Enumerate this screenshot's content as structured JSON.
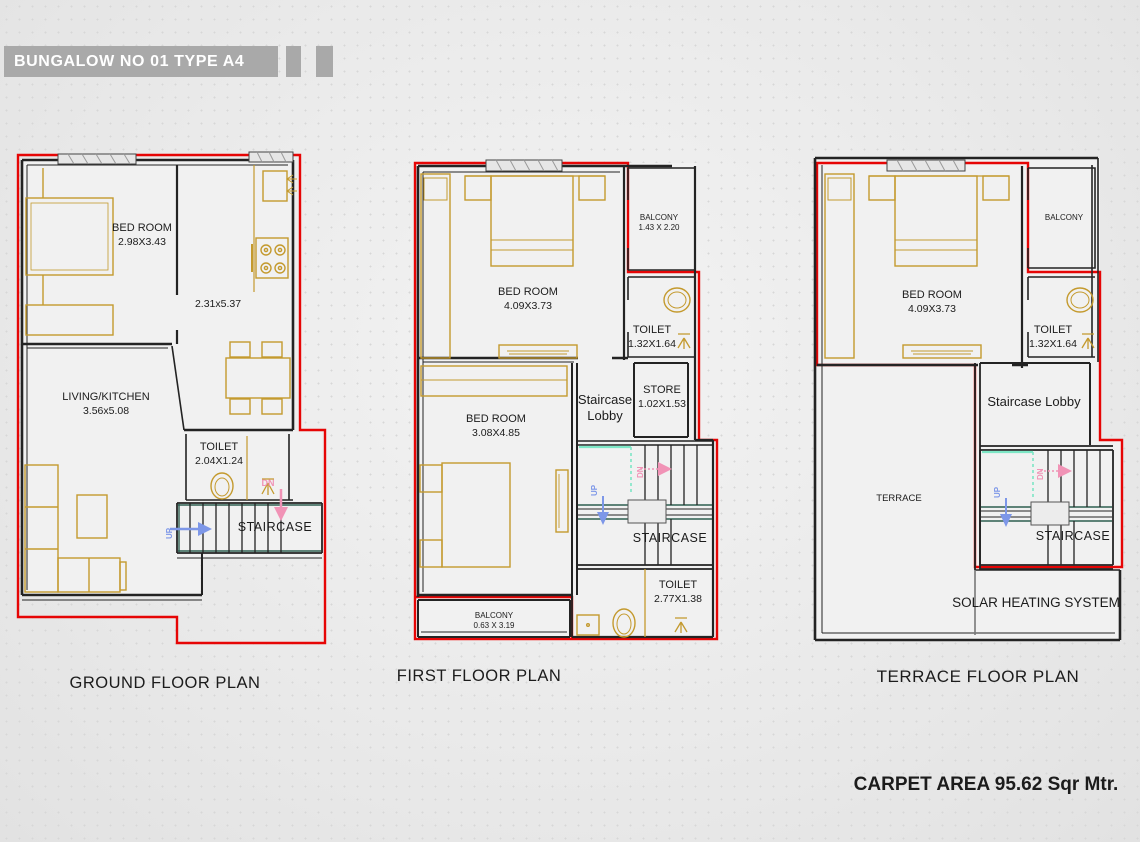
{
  "sheet": {
    "title": "BUNGALOW NO 01 TYPE A4",
    "carpet_area": "CARPET AREA 95.62 Sqr Mtr."
  },
  "colors": {
    "titlebar": "#a9a9a9",
    "outline_red": "#e60505",
    "wall_black": "#232323",
    "furniture_gold": "#c49a2e",
    "stair_teal": "#2e5f51",
    "mint": "#7de6c5",
    "arrow_blue": "#7d97e8",
    "arrow_pink": "#f193b6"
  },
  "plans": {
    "ground": {
      "title": "GROUND FLOOR PLAN",
      "labels": {
        "bedroom": {
          "name": "BED ROOM",
          "dim": "2.98X3.43"
        },
        "kitchen": {
          "dim": "2.31x5.37"
        },
        "living": {
          "name": "LIVING/KITCHEN",
          "dim": "3.56x5.08"
        },
        "toilet": {
          "name": "TOILET",
          "dim": "2.04X1.24"
        },
        "staircase": {
          "name": "STAIRCASE"
        },
        "up": "UP",
        "dn": "DN"
      }
    },
    "first": {
      "title": "FIRST FLOOR PLAN",
      "labels": {
        "bedroom1": {
          "name": "BED ROOM",
          "dim": "4.09X3.73"
        },
        "balcony1": {
          "name": "BALCONY",
          "dim": "1.43 X 2.20"
        },
        "toilet1": {
          "name": "TOILET",
          "dim": "1.32X1.64"
        },
        "lobby": {
          "line1": "Staircase",
          "line2": "Lobby"
        },
        "store": {
          "name": "STORE",
          "dim": "1.02X1.53"
        },
        "bedroom2": {
          "name": "BED ROOM",
          "dim": "3.08X4.85"
        },
        "staircase": {
          "name": "STAIRCASE"
        },
        "toilet2": {
          "name": "TOILET",
          "dim": "2.77X1.38"
        },
        "balcony2": {
          "name": "BALCONY",
          "dim": "0.63 X 3.19"
        },
        "up": "UP",
        "dn": "DN"
      }
    },
    "terrace": {
      "title": "TERRACE FLOOR PLAN",
      "labels": {
        "bedroom": {
          "name": "BED ROOM",
          "dim": "4.09X3.73"
        },
        "balcony": {
          "name": "BALCONY"
        },
        "toilet": {
          "name": "TOILET",
          "dim": "1.32X1.64"
        },
        "lobby": {
          "name": "Staircase Lobby"
        },
        "terrace": {
          "name": "TERRACE"
        },
        "staircase": {
          "name": "STAIRCASE"
        },
        "solar": {
          "name": "SOLAR HEATING SYSTEM"
        },
        "up": "UP",
        "dn": "DN"
      }
    }
  }
}
